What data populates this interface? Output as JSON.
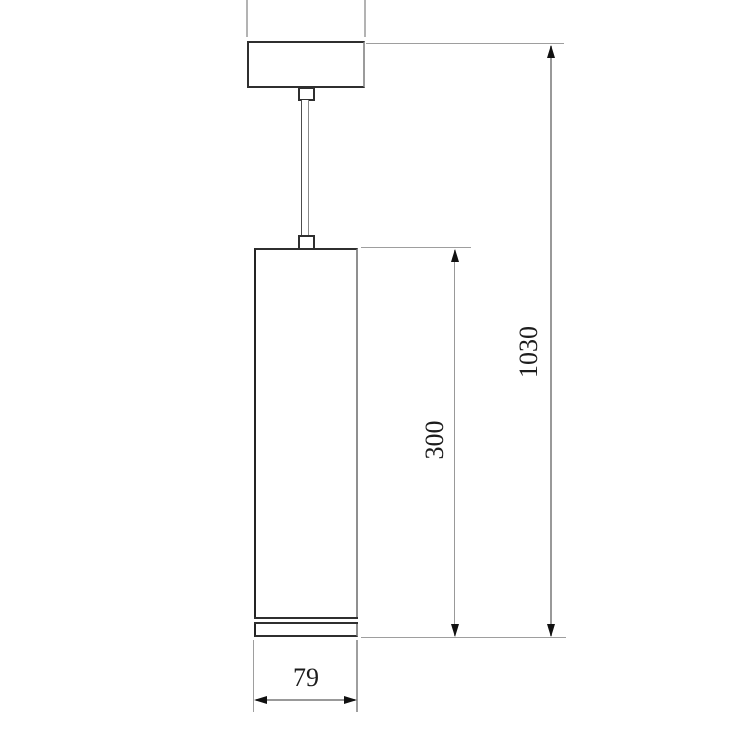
{
  "drawing": {
    "type": "technical-dimension-drawing",
    "subject": "cylindrical pendant lamp (ceiling canopy, suspension cord, tube luminaire)",
    "background_color": "#ffffff",
    "line_colors": {
      "object_lines": "#2f2f2f",
      "shaded_edges": "#8f8f8f",
      "dimension_lines": "#999999",
      "extension_lines": "#9e9e9e",
      "crop_lines": "#b3b3b3",
      "arrowheads": "#111111",
      "text": "#1c1c1c"
    },
    "dimensions": {
      "overall_height": {
        "label": "1030",
        "orientation": "vertical",
        "measures": "top of canopy to bottom of lamp body"
      },
      "body_height": {
        "label": "300",
        "orientation": "vertical",
        "measures": "height of cylindrical lamp body"
      },
      "body_width": {
        "label": "79",
        "orientation": "horizontal",
        "measures": "diameter of cylindrical lamp body"
      }
    }
  }
}
